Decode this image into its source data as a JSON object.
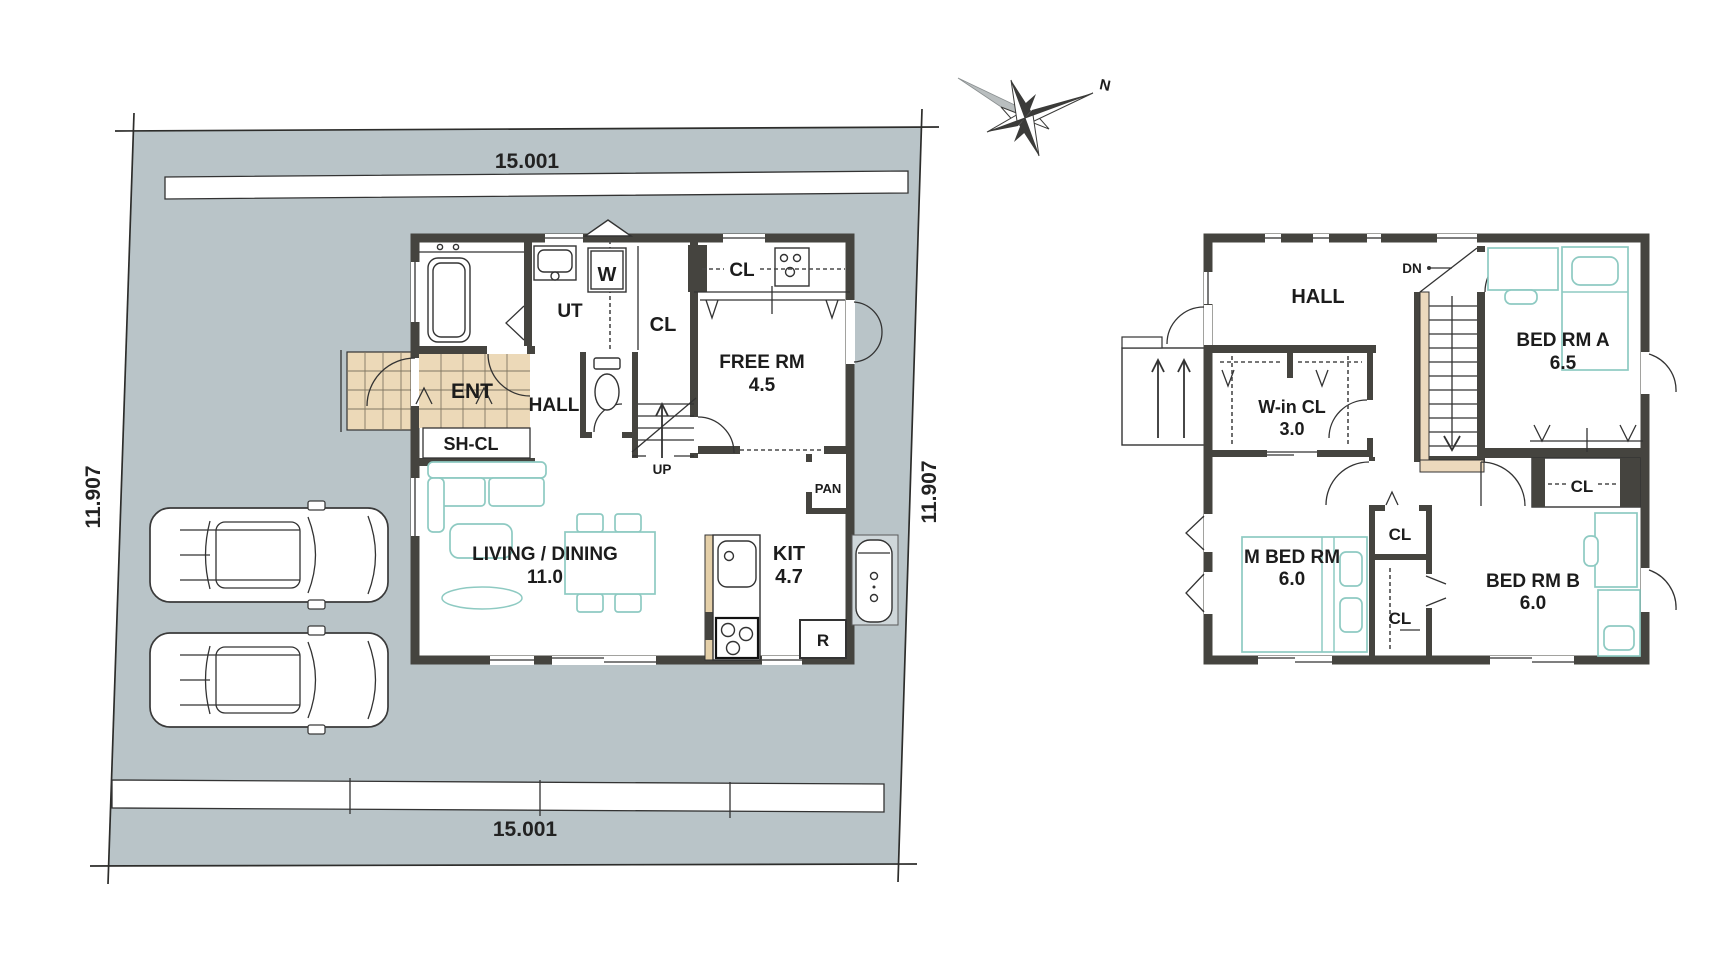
{
  "site": {
    "dim_top": "15.001",
    "dim_bottom": "15.001",
    "dim_left": "11.907",
    "dim_right": "11.907"
  },
  "compass": {
    "north": "N"
  },
  "floor1": {
    "ent": "ENT",
    "sh_cl": "SH-CL",
    "hall": "HALL",
    "ut": "UT",
    "washer": "W",
    "cl_corridor": "CL",
    "cl_closet": "CL",
    "free_rm": "FREE RM",
    "free_rm_area": "4.5",
    "up": "UP",
    "living": "LIVING / DINING",
    "living_area": "11.0",
    "kit": "KIT",
    "kit_area": "4.7",
    "pan": "PAN",
    "fridge": "R"
  },
  "floor2": {
    "hall": "HALL",
    "dn": "DN",
    "bed_a": "BED RM A",
    "bed_a_area": "6.5",
    "win_cl": "W-in CL",
    "win_cl_area": "3.0",
    "cl_bed_a": "CL",
    "cl_center": "CL",
    "cl_lower": "CL",
    "m_bed": "M BED RM",
    "m_bed_area": "6.0",
    "bed_b": "BED RM B",
    "bed_b_area": "6.0"
  },
  "colors": {
    "site_fill": "#b9c4c8",
    "wall": "#45443f",
    "furniture": "#8ecac2",
    "tile": "#ecd9b8",
    "stair_accent": "#ecd9bd"
  }
}
